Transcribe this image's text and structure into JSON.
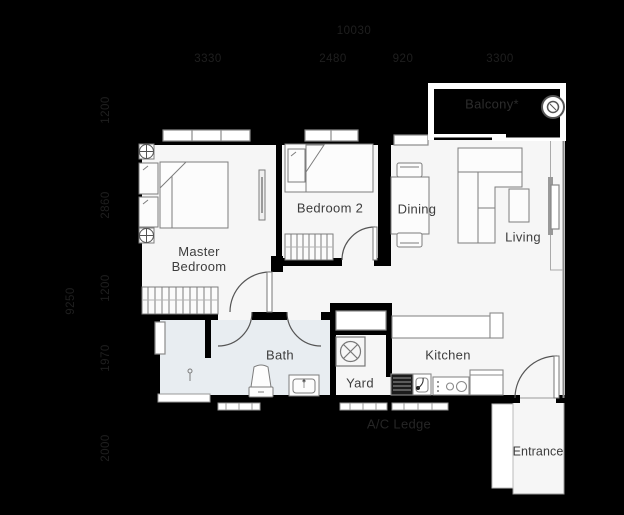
{
  "plan": {
    "dims": {
      "top": {
        "overall": "10030",
        "segments": [
          "3330",
          "2480",
          "920",
          "3300"
        ]
      },
      "left": {
        "overall": "9250",
        "segments": [
          "1200",
          "2860",
          "1200",
          "1970",
          "2000"
        ]
      }
    },
    "rooms": {
      "master_bedroom": "Master Bedroom",
      "bedroom_2": "Bedroom 2",
      "dining": "Dining",
      "living": "Living",
      "bath": "Bath",
      "yard": "Yard",
      "kitchen": "Kitchen",
      "entrance": "Entrance",
      "balcony": "Balcony*",
      "ac_ledge": "A/C Ledge"
    },
    "icons": {
      "balcony_drain": "concentric-circles",
      "column_marker": "circled-cross",
      "washing_machine": "circle-x-in-square",
      "shower_head": "pin"
    },
    "colors": {
      "background": "#000000",
      "floor": "#f6f6f6",
      "bath_floor": "#e8edf1",
      "wall": "#000000",
      "balcony_wall": "#ffffff",
      "furniture_outline": "#7d7d7d",
      "dim_text": "#1f1f1f",
      "label_text": "#3d3d3d"
    }
  }
}
